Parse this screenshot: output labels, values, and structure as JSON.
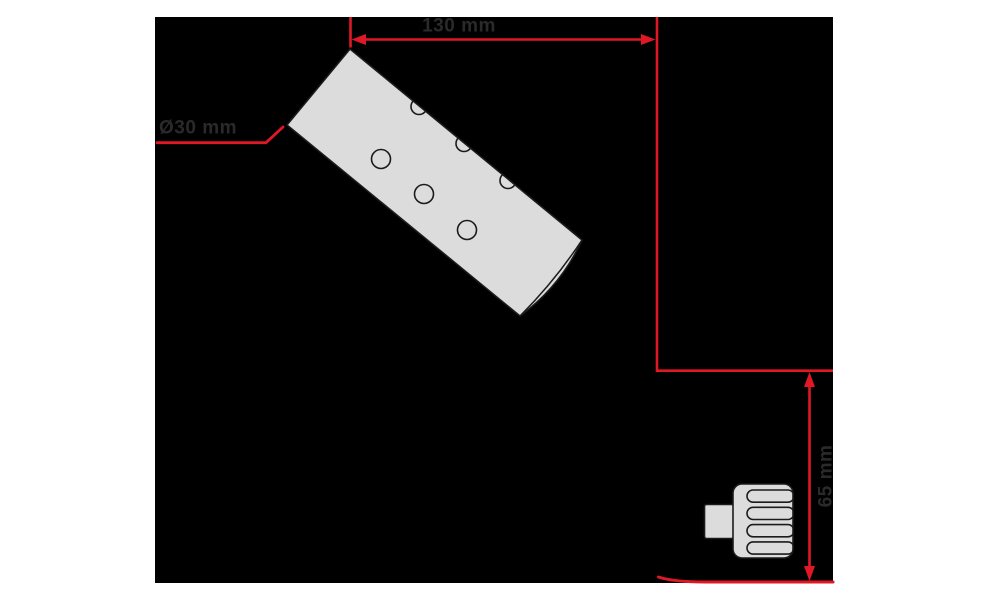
{
  "colors": {
    "page_background": "#ffffff",
    "canvas_background": "#000000",
    "dimension_red": "#e01826",
    "part_fill": "#dcdcdc",
    "part_outline": "#1b1b1b",
    "label_text": "#2a2a2a"
  },
  "dimensions": {
    "length": {
      "label": "130 mm",
      "orientation": "horizontal"
    },
    "diameter": {
      "label": "Ø30 mm",
      "orientation": "leader"
    },
    "height": {
      "label": "65 mm",
      "orientation": "vertical"
    }
  },
  "parts": {
    "spray_bar": {
      "name": "perforated-bar",
      "face_holes": 3,
      "edge_holes": 3
    },
    "knob": {
      "name": "ribbed-knob",
      "ribs": 4
    }
  }
}
